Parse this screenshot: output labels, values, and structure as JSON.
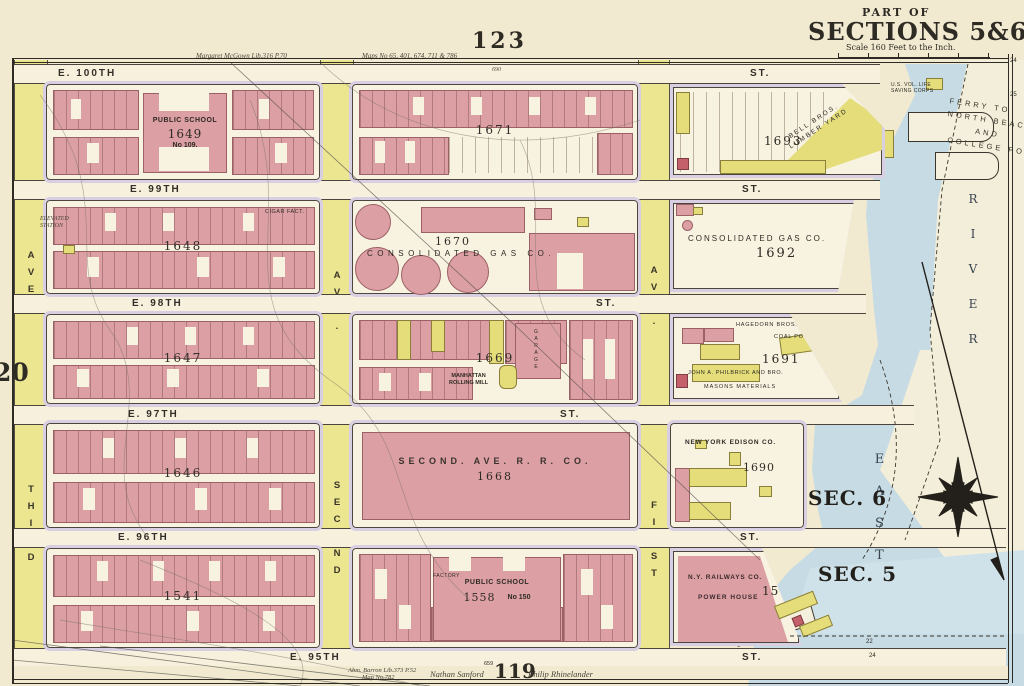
{
  "header": {
    "page_number": "123",
    "part_of": "PART OF",
    "sections": "SECTIONS 5&6",
    "scale": "Scale 160 Feet to the Inch.",
    "ref_left": "Margaret McGown Lib.316 P.70",
    "ref_right": "Maps No 65, 401, 674, 711 & 786"
  },
  "footer": {
    "page_number": "119",
    "ref1": "Abm. Barron Lib.373 P.52",
    "ref2": "Map No.782",
    "name_left": "Nathan Sanford",
    "name_right": "Philip Rhinelander",
    "dim": "659"
  },
  "margins": {
    "left_plate": "20",
    "right_top": "24",
    "right_mid": "25",
    "bottom_a": "22",
    "bottom_b": "24"
  },
  "streets": [
    {
      "name": "E. 100TH",
      "st": "ST.",
      "dim": "690"
    },
    {
      "name": "E. 99TH",
      "st": "ST."
    },
    {
      "name": "E. 98TH",
      "st": "ST."
    },
    {
      "name": "E. 97TH",
      "st": "ST."
    },
    {
      "name": "E. 96TH",
      "st": "ST."
    },
    {
      "name": "E. 95TH",
      "st": "ST."
    }
  ],
  "avenues": {
    "third": {
      "ave": "AVE.",
      "name": "THIRD"
    },
    "second": {
      "ave": "AVE.",
      "name": "SECOND"
    },
    "first": {
      "ave": "AVE.",
      "name": "FIRST"
    }
  },
  "blocks": {
    "b1649": {
      "number": "1649",
      "l1": "PUBLIC SCHOOL",
      "l2": "1649",
      "l3": "No 109."
    },
    "b1671": {
      "number": "1671"
    },
    "b1693": {
      "number": "1693",
      "yard1": "BELL BROS.",
      "yard2": "LUMBER YARD"
    },
    "b1648": {
      "number": "1648",
      "note": "CIGAR FACT."
    },
    "b1670": {
      "number": "1670",
      "name": "CONSOLIDATED GAS CO."
    },
    "b1692": {
      "number": "1692",
      "name": "CONSOLIDATED GAS CO."
    },
    "b1647": {
      "number": "1647"
    },
    "b1669": {
      "number": "1669",
      "mill1": "MANHATTAN",
      "mill2": "ROLLING MILL",
      "garage": "GARAGE"
    },
    "b1691": {
      "number": "1691",
      "n1": "HAGEDORN BROS.",
      "n2": "COAL POCKET",
      "n3": "JOHN A. PHILBRICK AND BRO.",
      "n4": "MASONS MATERIALS"
    },
    "b1646": {
      "number": "1646"
    },
    "b1668": {
      "number": "1668",
      "name": "SECOND. AVE. R. R. CO."
    },
    "b1690": {
      "number": "1690",
      "name": "NEW YORK EDISON CO."
    },
    "b1541": {
      "number": "1541"
    },
    "b1558": {
      "number": "1558",
      "l1": "PUBLIC SCHOOL",
      "l2": "No 150",
      "factory": "FACTORY"
    },
    "b1575": {
      "number": "1575",
      "name": "N.Y. RAILWAYS CO.",
      "l2": "POWER HOUSE"
    }
  },
  "river": {
    "east": "EAST",
    "river": "RIVER",
    "sec6": "SEC. 6",
    "sec5": "SEC. 5",
    "ferry": {
      "l1": "FERRY TO",
      "l2": "NORTH BEACH",
      "l3": "AND",
      "l4": "COLLEGE POINT"
    },
    "life_saving1": "U.S. VOL. LIFE",
    "life_saving2": "SAVING CORPS"
  },
  "notes": {
    "elevated1": "ELEVATED",
    "elevated2": "STATION"
  },
  "colors": {
    "pink": "#dc9fa4",
    "yellow": "#e4dd7a",
    "river": "#c6dbe4",
    "lavender": "#d8cfe3",
    "paper": "#f1ead0"
  }
}
